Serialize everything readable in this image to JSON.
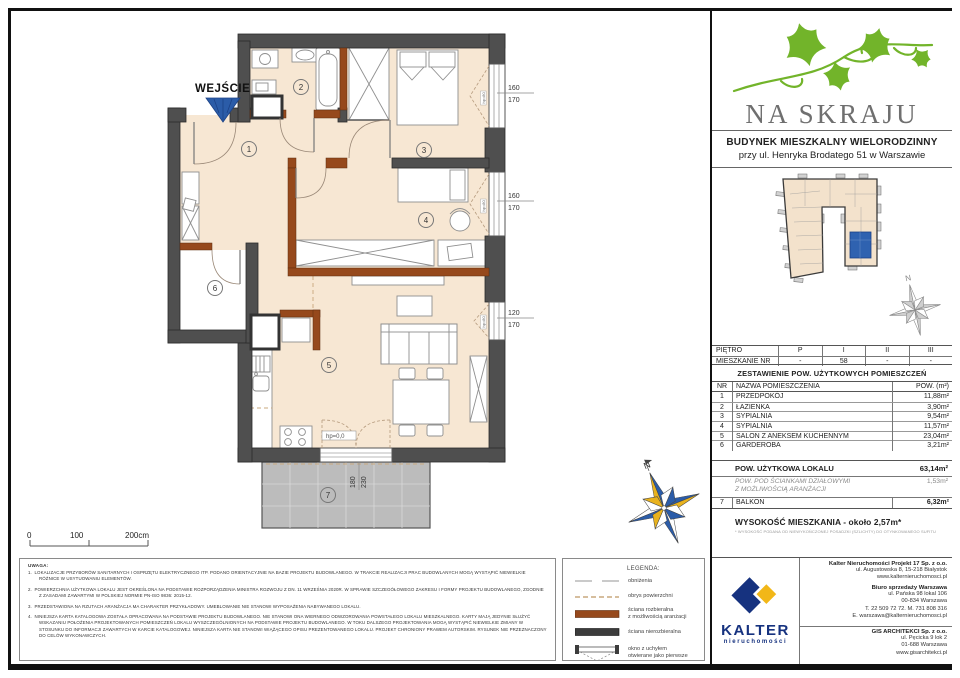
{
  "colors": {
    "wall_dark": "#4f4f4f",
    "wall_removable_brown": "#96491c",
    "floor_beige": "#f7e7d3",
    "balcony_gray": "#bcbcbc",
    "accent_blue": "#2b5ca8",
    "brand_green": "#72b42a",
    "brand_gray": "#6f6f6f",
    "kalter_navy": "#16327f",
    "kalter_yellow": "#f2b718"
  },
  "brand": {
    "name": "NA SKRAJU",
    "building_line1": "BUDYNEK MIESZKALNY WIELORODZINNY",
    "building_line2": "przy ul. Henryka Brodatego 51 w Warszawie"
  },
  "plan": {
    "entrance_label": "WEJŚCIE",
    "rooms": [
      "1",
      "2",
      "3",
      "4",
      "5",
      "6",
      "7"
    ],
    "window_dims": [
      {
        "a": "160",
        "b": "170"
      },
      {
        "a": "160",
        "b": "170"
      },
      {
        "a": "120",
        "b": "170"
      }
    ],
    "door_dim": {
      "a": "180",
      "b": "230"
    },
    "hp_window": "hp=80",
    "hp_door": "hp=0,0",
    "north": "N",
    "scale": {
      "t0": "0",
      "t1": "100",
      "t2": "200cm"
    }
  },
  "site_plan": {
    "north": "N"
  },
  "floor_table": {
    "row1_label": "PIĘTRO",
    "row1": [
      "P",
      "I",
      "II",
      "III"
    ],
    "row2_label": "MIESZKANIE NR",
    "row2": [
      "-",
      "58",
      "-",
      "-"
    ]
  },
  "area_table": {
    "title": "ZESTAWIENIE POW. UŻYTKOWYCH POMIESZCZEŃ",
    "col_nr": "NR",
    "col_name": "NAZWA POMIESZCZENIA",
    "col_area": "POW. (m²)",
    "rows": [
      {
        "nr": "1",
        "name": "PRZEDPOKÓJ",
        "area": "11,88m²"
      },
      {
        "nr": "2",
        "name": "ŁAZIENKA",
        "area": "3,90m²"
      },
      {
        "nr": "3",
        "name": "SYPIALNIA",
        "area": "9,54m²"
      },
      {
        "nr": "4",
        "name": "SYPIALNIA",
        "area": "11,57m²"
      },
      {
        "nr": "5",
        "name": "SALON Z ANEKSEM KUCHENNYM",
        "area": "23,04m²"
      },
      {
        "nr": "6",
        "name": "GARDEROBA",
        "area": "3,21m²"
      }
    ],
    "total_label": "POW. UŻYTKOWA LOKALU",
    "total_value": "63,14m²",
    "partition_label": "POW. POD ŚCIANKAMI DZIAŁOWYMI\nZ MOŻLIWOŚCIĄ ARANŻACJI",
    "partition_value": "1,53m²",
    "balcony": {
      "nr": "7",
      "name": "BALKON",
      "area": "6,32m²"
    }
  },
  "height": {
    "label": "WYSOKOŚĆ MIESZKANIA - około 2,57m*",
    "footnote": "* WYSOKOŚĆ PODANA OD NIEWYKOŃCZONEJ POSADZKI (SZLICHTY) DO OTYNKOWANEGO SUFITU"
  },
  "legend": {
    "title": "LEGENDA:",
    "items": [
      "obniżenia",
      "obrys powierzchni",
      "ściana rozbieralna\nz możliwością aranżacji",
      "ściana nierozbieralna",
      "okno z uchyłem\notwierane jako pierwsze"
    ]
  },
  "notes": {
    "title": "UWAGA:",
    "items": [
      "LOKALIZACJE PRZYBORÓW SANITARNYCH I OSPRZĘTU ELEKTRYCZNEGO ITP. PODANO ORIENTACYJNIE NA BAZIE PROJEKTU BUDOWLANEGO. W TRAKCIE REALIZACJI PRAC BUDOWLANYCH MOGĄ WYSTĄPIĆ NIEWIELKIE RÓŻNICE W USYTUOWANIU ELEMENTÓW.",
      "POWIERZCHNIA UŻYTKOWA LOKALU JEST OKREŚLONA NA PODSTAWIE ROZPORZĄDZENIA MINISTRA ROZWOJU Z DN. 11 WRZEŚNIA 2020R. W SPRAWIE SZCZEGÓŁOWEGO ZAKRESU I FORMY PROJEKTU BUDOWLANEGO, ZGODNIE Z ZASADAMI ZAWARTYMI W POLSKIEJ NORMIE PN-ISO 9836: 2015-12.",
      "PRZEDSTAWIONA NA RZUTACH ARANŻACJA MA CHARAKTER PRZYKŁADOWY. UMEBLOWANIE NIE STANOWI WYPOSAŻENIA NABYWANEGO LOKALU.",
      "NINIEJSZA KARTA KATALOGOWA ZOSTAŁA OPRACOWANA NA PODSTAWIE PROJEKTU BUDOWLANEGO. NIE STANOWI ONA WIERNEGO ODWZOROWANIA POWSTAŁEGO LOKALU MIESZKALNEGO. KARTY MAJĄ JEDYNIE SŁUŻYĆ WSKAZANIU POŁOŻENIA PROJEKTOWANYCH POMIESZCZEŃ LOKALU WYSZCZEGÓLNIONYCH NA PODSTAWIE PROJEKTU BUDOWLANEGO. W TOKU DALSZEGO PROJEKTOWANIA MOGĄ WYSTĄPIĆ NIEWIELKIE ZMIANY W STOSUNKU DO INFORMACJI ZAWARTYCH W KARCIE KATALOGOWEJ. NINIEJSZA KARTA NIE STANOWI WIĄŻĄCEGO OPISU PREZENTOWANEGO LOKALU. PROJEKT CHRONIONY PRAWEM AUTORSKIM. RYSUNEK NIE PRZEZNACZONY DO CELÓW WYKONAWCZYCH."
    ]
  },
  "contacts": {
    "kalter_brand": "KALTER",
    "kalter_sub": "nieruchomości",
    "hq_name": "Kalter Nieruchomości Projekt 17 Sp. z o.o.",
    "hq_lines": "ul. Augustowska 8, 15-218 Białystok\nwww.kalternieruchomosci.pl",
    "office_name": "Biuro sprzedaży Warszawa",
    "office_lines": "ul. Pańska 98 lokal 106\n00-834 Warszawa\nT. 22 509 72 72. M. 731 808 316\nE. warszawa@kalternieruchomosci.pl",
    "gis_name": "GIS ARCHITEKCI Sp. z o.o.",
    "gis_lines": "ul. Pęcicka 9 lok 2\n01-688 Warszawa\nwww.gisarchitekci.pl"
  }
}
